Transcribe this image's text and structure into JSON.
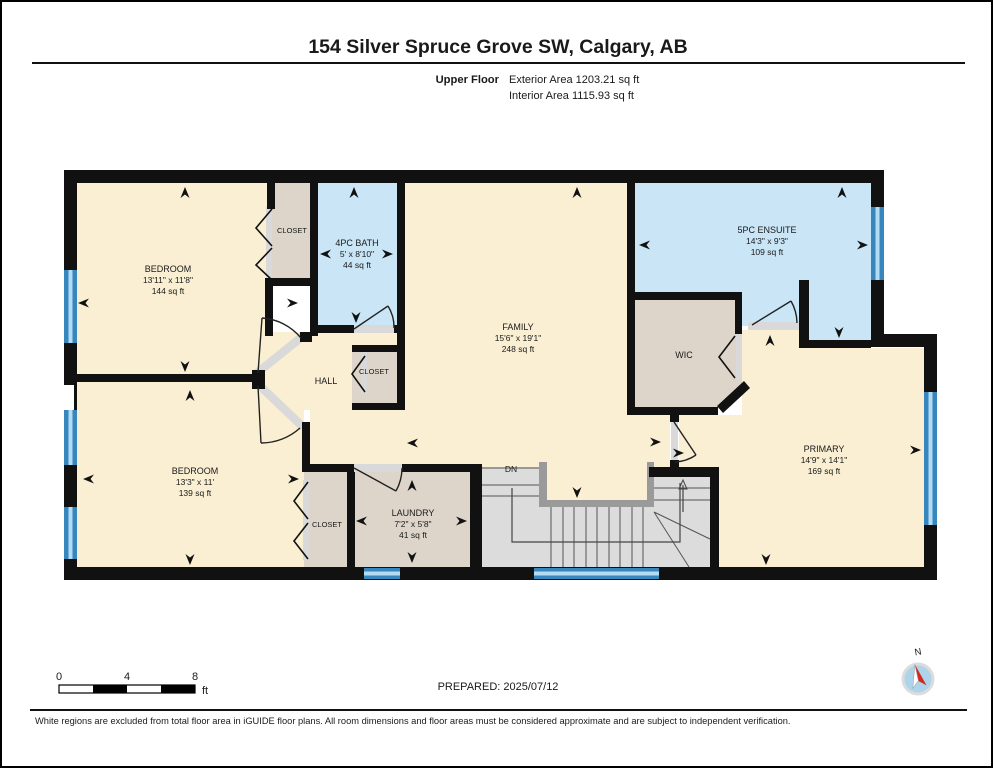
{
  "header": {
    "title": "154 Silver Spruce Grove SW, Calgary, AB",
    "floor_label": "Upper Floor",
    "exterior_area": "Exterior Area 1203.21 sq ft",
    "interior_area": "Interior Area 1115.93 sq ft"
  },
  "rooms": {
    "bedroom1": {
      "name": "BEDROOM",
      "dims": "13'11\" x 11'8\"",
      "area": "144 sq ft"
    },
    "closet1": {
      "name": "CLOSET"
    },
    "bath": {
      "name": "4PC BATH",
      "dims": "5' x 8'10\"",
      "area": "44 sq ft"
    },
    "family": {
      "name": "FAMILY",
      "dims": "15'6\" x 19'1\"",
      "area": "248 sq ft"
    },
    "ensuite": {
      "name": "5PC ENSUITE",
      "dims": "14'3\" x 9'3\"",
      "area": "109 sq ft"
    },
    "wic": {
      "name": "WIC"
    },
    "hall": {
      "name": "HALL"
    },
    "hall_closet": {
      "name": "CLOSET"
    },
    "bedroom2": {
      "name": "BEDROOM",
      "dims": "13'3\" x 11'",
      "area": "139 sq ft"
    },
    "closet2": {
      "name": "CLOSET"
    },
    "laundry": {
      "name": "LAUNDRY",
      "dims": "7'2\" x 5'8\"",
      "area": "41 sq ft"
    },
    "primary": {
      "name": "PRIMARY",
      "dims": "14'9\" x 14'1\"",
      "area": "169 sq ft"
    },
    "stairs": {
      "down_label": "DN"
    }
  },
  "scale_bar": {
    "tick0": "0",
    "tick4": "4",
    "tick8": "8",
    "unit": "ft"
  },
  "compass": {
    "north_label": "N"
  },
  "footer": {
    "prepared": "PREPARED: 2025/07/12",
    "disclaimer": "White regions are excluded from total floor area in iGUIDE floor plans. All room dimensions and floor areas must be considered approximate and are subject to independent verification."
  },
  "colors": {
    "room_fill": "#faefd3",
    "wet_room_fill": "#c9e5f6",
    "closet_fill": "#ddd5ca",
    "stair_fill": "#dcdcdc",
    "window_blue": "#3786bd",
    "wall_black": "#111111"
  }
}
